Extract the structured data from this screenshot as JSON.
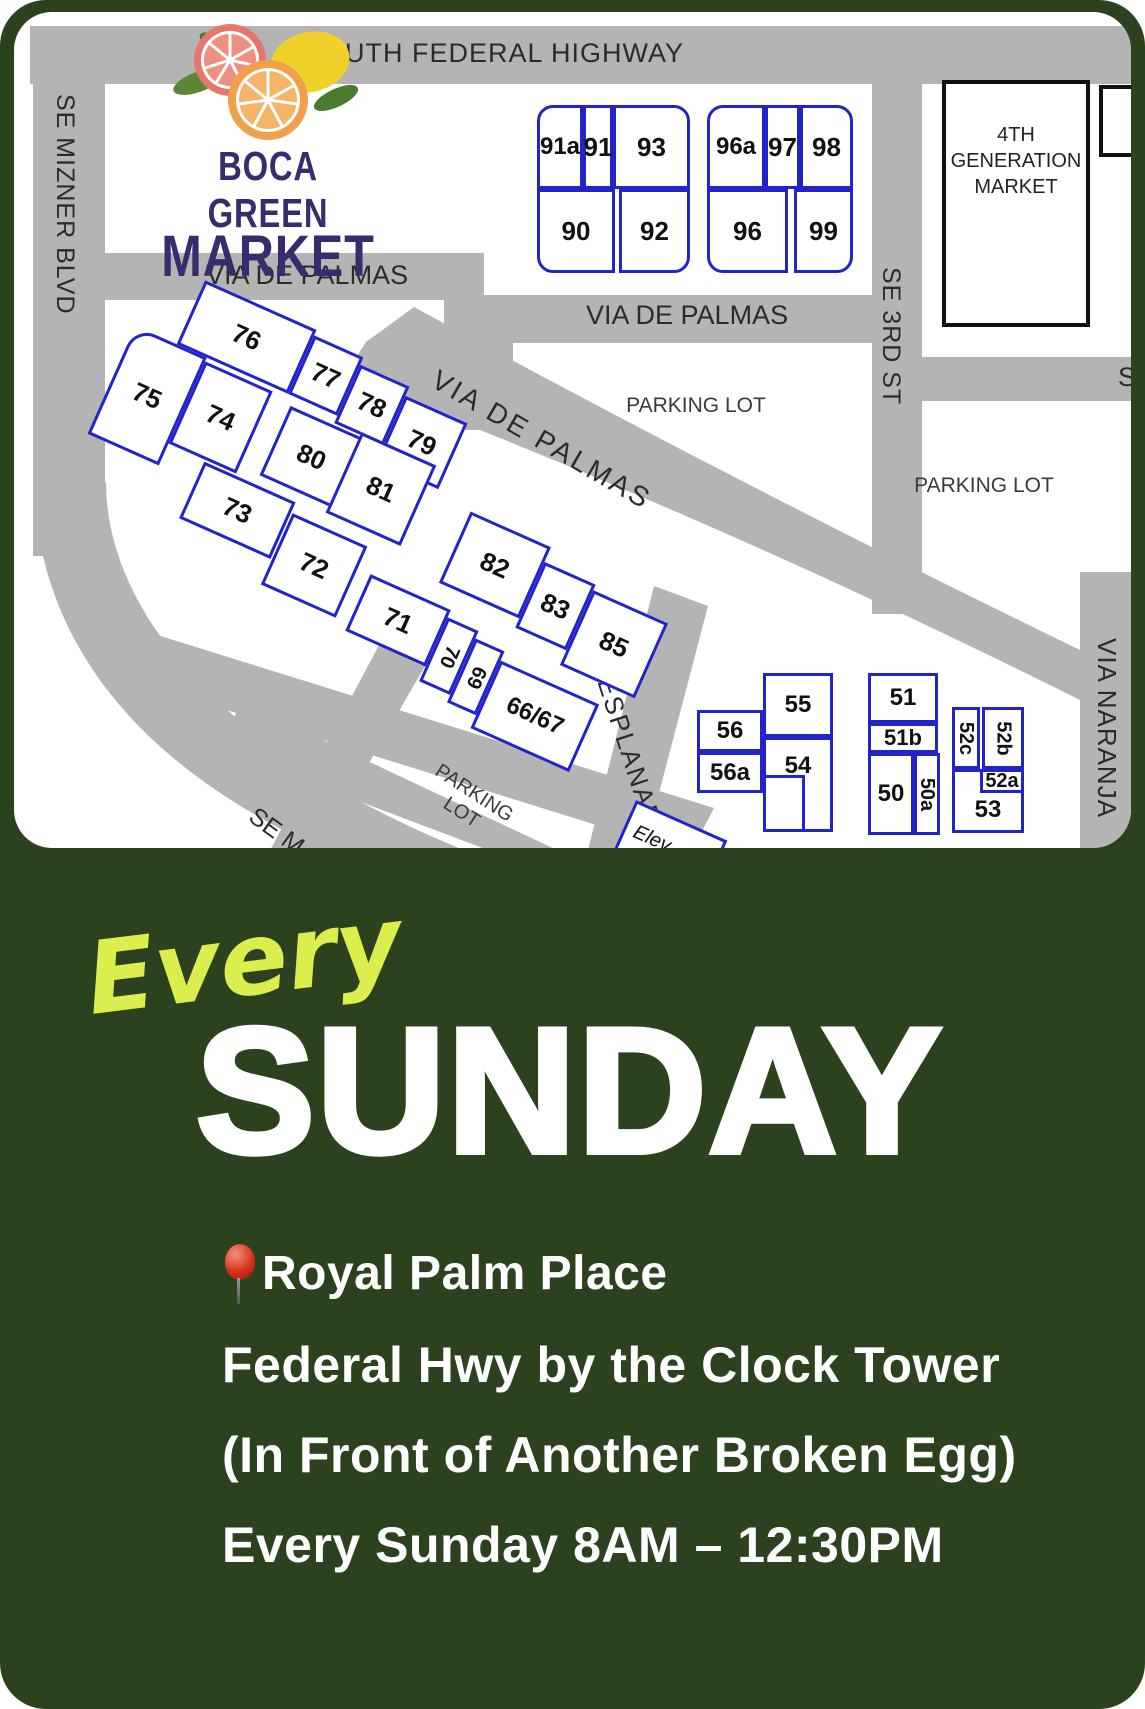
{
  "flyer": {
    "headline_script": "Every",
    "headline_day": "SUNDAY",
    "location_name": "Royal Palm Place",
    "location_line2": "Federal Hwy by the Clock Tower",
    "location_line3": "(In Front of Another Broken Egg)",
    "schedule": "Every Sunday 8AM – 12:30PM"
  },
  "logo": {
    "line1": "BOCA GREEN",
    "line2": "MARKET"
  },
  "map": {
    "streets": {
      "south_federal_highway": "SOUTH FEDERAL HIGHWAY",
      "se_mizner_blvd": "SE MIZNER BLVD",
      "via_de_palmas_west": "VIA DE PALMAS",
      "via_de_palmas_east": "VIA DE PALMAS",
      "via_de_palmas_diagonal": "VIA DE PALMAS",
      "se_3rd_st": "SE 3RD ST",
      "esplanade": "ESPLANADE",
      "via_naranja": "VIA NARANJA",
      "se_partial": "SE M",
      "s_partial": "S"
    },
    "labels": {
      "parking_lot_west": "PARKING LOT",
      "parking_lot_east": "PARKING LOT",
      "parking_lot_diagonal": "PARKING LOT",
      "fourth_generation_market": "4TH GENERATION MARKET",
      "elevator": "Elev"
    },
    "lots": {
      "l91a": "91a",
      "l91": "91",
      "l93": "93",
      "l90": "90",
      "l92": "92",
      "l96a": "96a",
      "l97": "97",
      "l98": "98",
      "l96": "96",
      "l99": "99",
      "l76": "76",
      "l77": "77",
      "l78": "78",
      "l79": "79",
      "l75": "75",
      "l74": "74",
      "l80": "80",
      "l73": "73",
      "l81": "81",
      "l82": "82",
      "l83": "83",
      "l85": "85",
      "l72": "72",
      "l71": "71",
      "l70": "70",
      "l69": "69",
      "l6667": "66/67",
      "l55": "55",
      "l54": "54",
      "l56": "56",
      "l56a": "56a",
      "l51": "51",
      "l51b": "51b",
      "l50": "50",
      "l50a": "50a",
      "l52c": "52c",
      "l52b": "52b",
      "l52a": "52a",
      "l53": "53"
    }
  },
  "colors": {
    "background_green": "#2c421e",
    "accent_yellow": "#dcee4e",
    "lot_blue": "#2323cc",
    "road_gray": "#b4b4b4",
    "logo_purple": "#3a2a6e",
    "pin_red": "#d92f1d"
  }
}
